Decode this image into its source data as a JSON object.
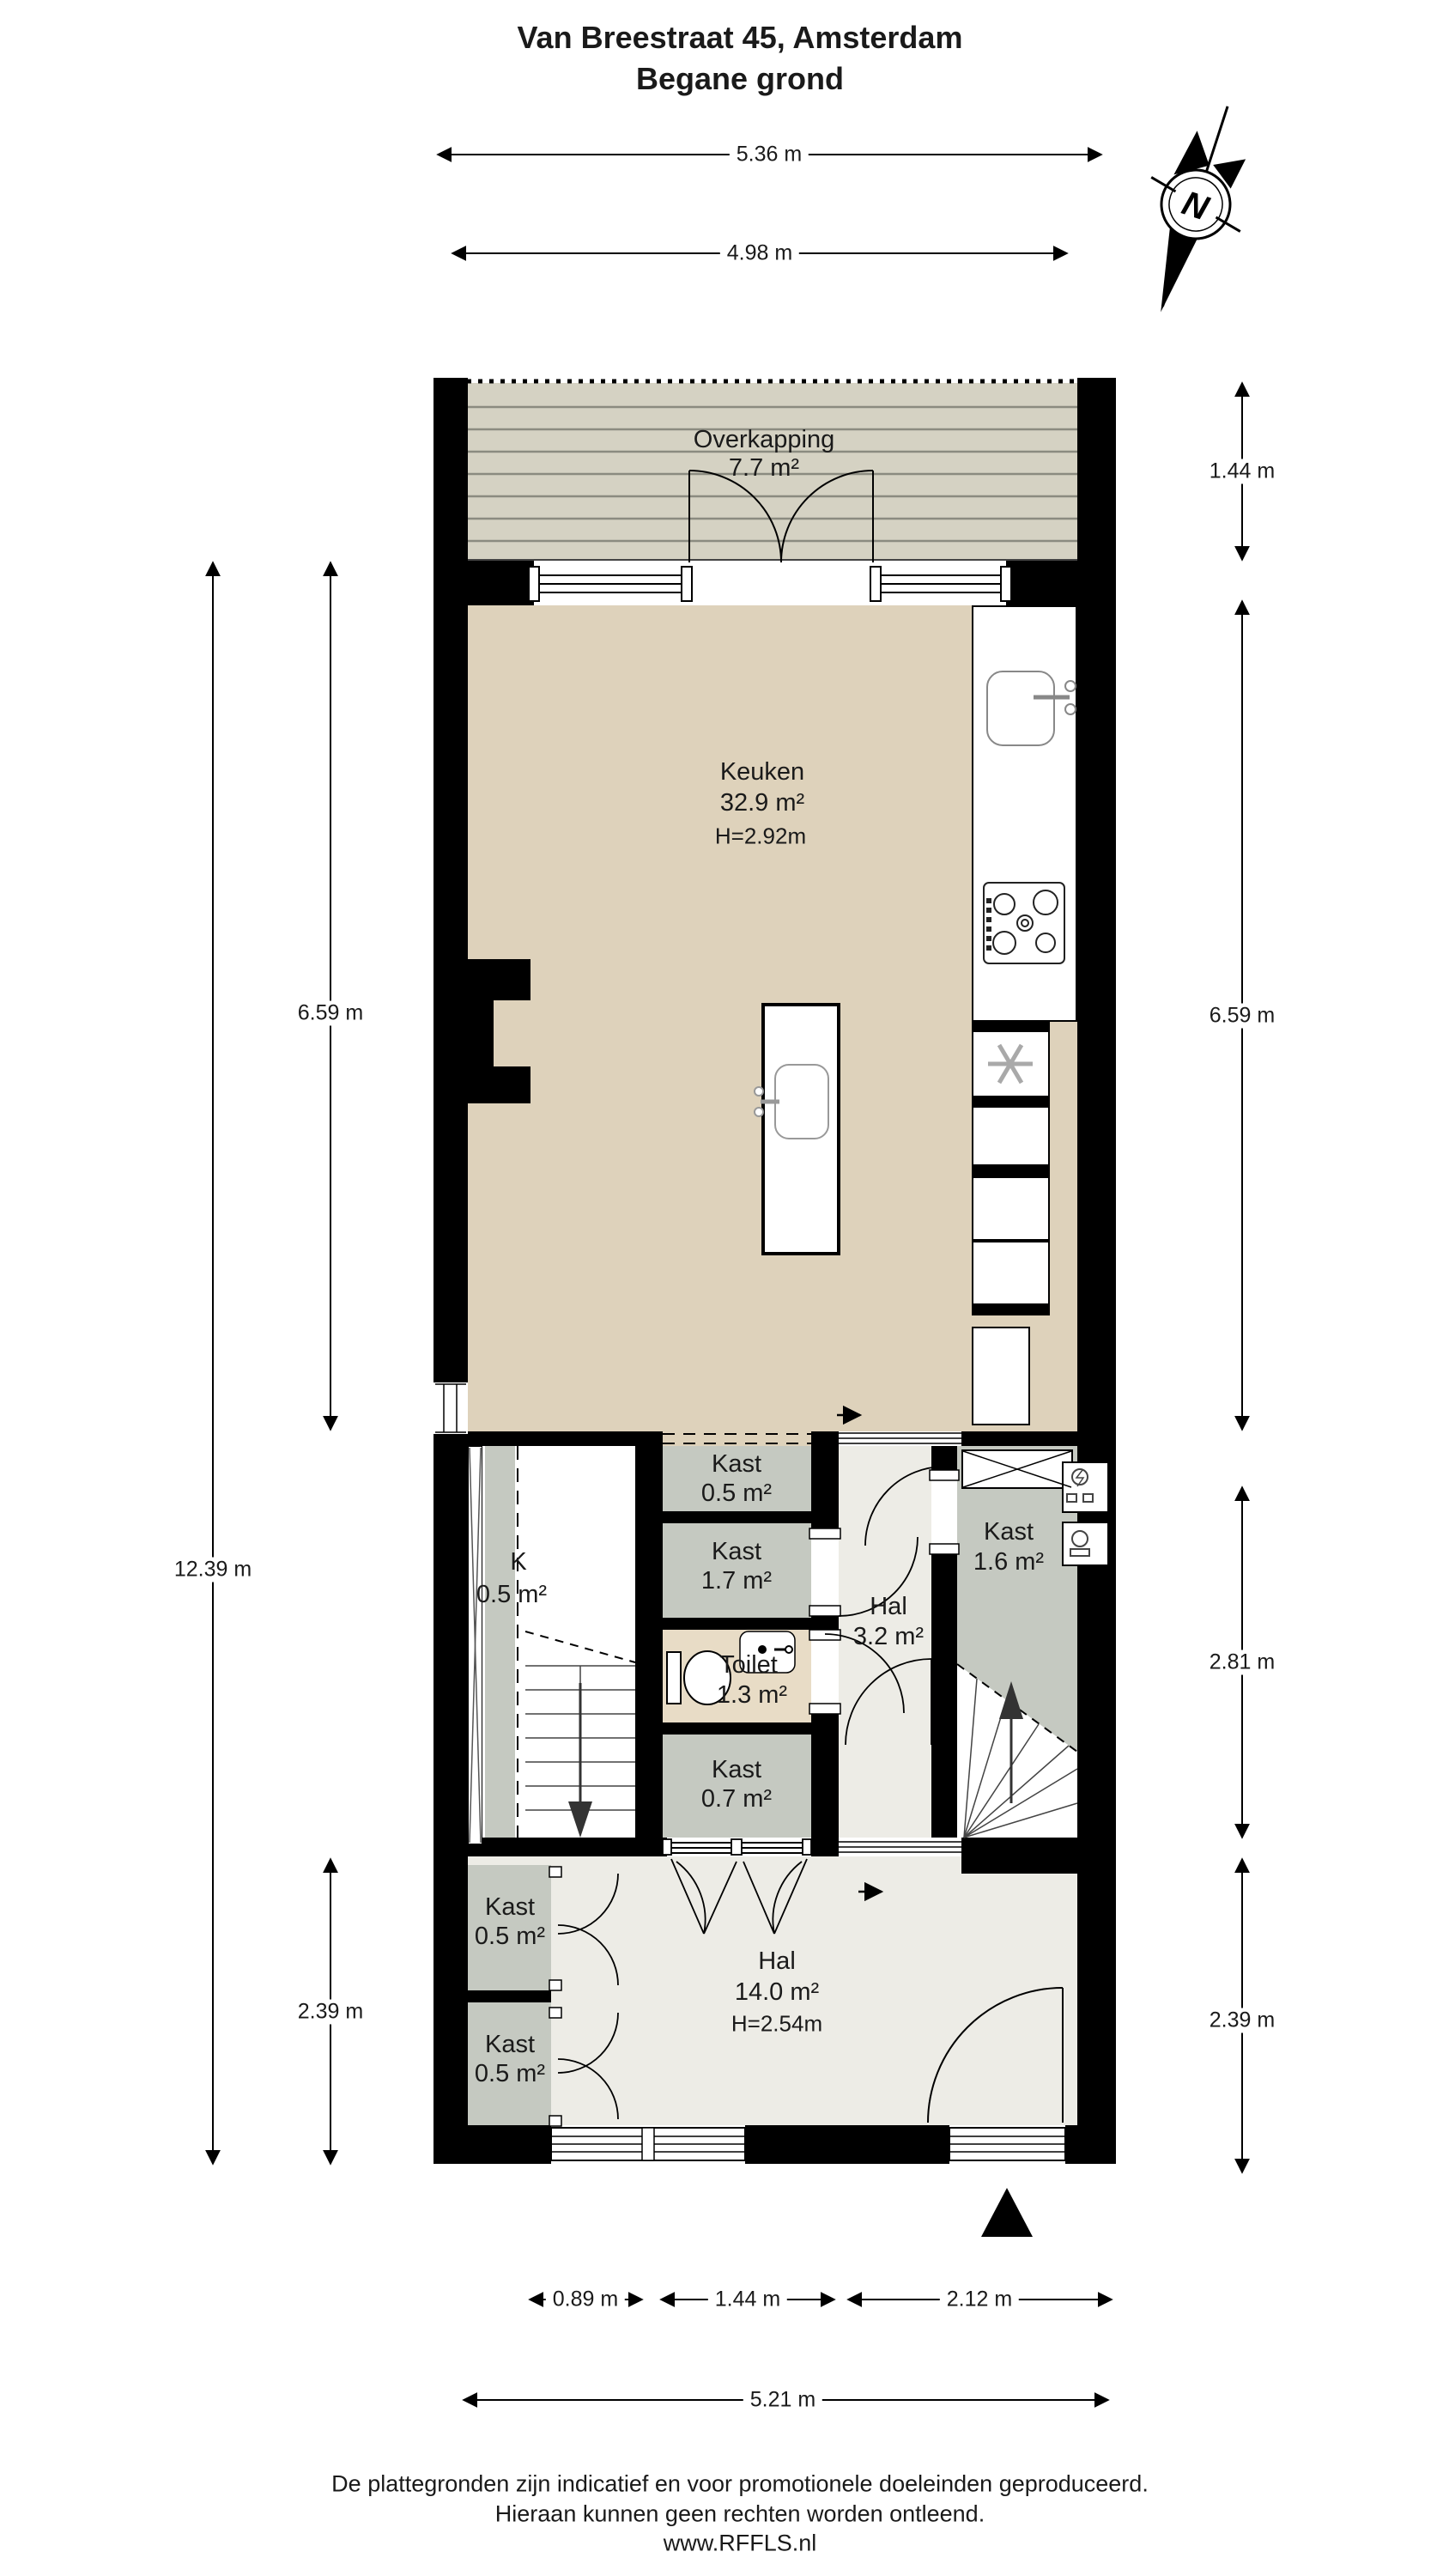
{
  "title": {
    "line1": "Van Breestraat 45, Amsterdam",
    "line2": "Begane grond"
  },
  "compass": {
    "label": "N"
  },
  "colors": {
    "wall": "#000000",
    "kitchenFloor": "#ded2bb",
    "deckFloor": "#d5d2c3",
    "deckLine": "#8b8b80",
    "kastFloor": "#c5c9c1",
    "halFloor": "#edece6",
    "toiletFloor": "#e8dcc6",
    "line": "#1a1a1a"
  },
  "rooms": {
    "overkapping": {
      "name": "Overkapping",
      "area": "7.7 m²"
    },
    "keuken": {
      "name": "Keuken",
      "area": "32.9 m²",
      "height": "H=2.92m"
    },
    "kast_top": {
      "name": "Kast",
      "area": "0.5 m²"
    },
    "kast_groot": {
      "name": "Kast",
      "area": "1.7 m²"
    },
    "kast_links": {
      "name": "K",
      "area": "0.5 m²"
    },
    "toilet": {
      "name": "Toilet",
      "area": "1.3 m²"
    },
    "hal": {
      "name": "Hal",
      "area": "3.2 m²"
    },
    "kast_meter": {
      "name": "Kast",
      "area": "1.6 m²"
    },
    "kast_onder": {
      "name": "Kast",
      "area": "0.7 m²"
    },
    "kast_hal1": {
      "name": "Kast",
      "area": "0.5 m²"
    },
    "kast_hal2": {
      "name": "Kast",
      "area": "0.5 m²"
    },
    "hal_beneden": {
      "name": "Hal",
      "area": "14.0 m²",
      "height": "H=2.54m"
    }
  },
  "dimensions": {
    "top_outer": "5.36 m",
    "top_inner": "4.98 m",
    "left_total": "12.39 m",
    "left_kitchen": "6.59 m",
    "left_hal": "2.39 m",
    "right_overkapping": "1.44 m",
    "right_kitchen": "6.59 m",
    "right_middle": "2.81 m",
    "right_hal": "2.39 m",
    "bottom_kast": "0.89 m",
    "bottom_stair": "1.44 m",
    "bottom_hal": "2.12 m",
    "bottom_total": "5.21 m"
  },
  "footer": {
    "line1": "De plattegronden zijn indicatief en voor promotionele doeleinden geproduceerd.",
    "line2": "Hieraan kunnen geen rechten worden ontleend.",
    "line3": "www.RFFLS.nl"
  }
}
